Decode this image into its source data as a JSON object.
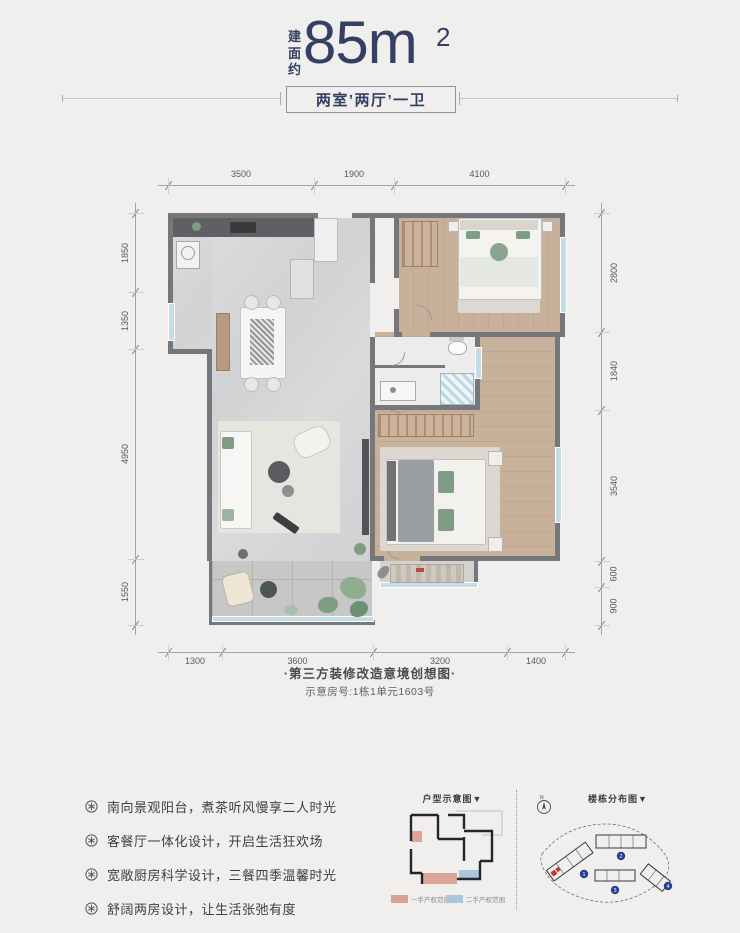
{
  "header": {
    "area_prefix": "建面约",
    "area_value": "85m",
    "area_sup": "2",
    "layout_label": "两室’两厅’一卫"
  },
  "plan": {
    "dims_top": [
      "3500",
      "1900",
      "4100"
    ],
    "dims_left": [
      "1850",
      "1350",
      "4950",
      "1550"
    ],
    "dims_right": [
      "2800",
      "1840",
      "3540",
      "600",
      "900"
    ],
    "dims_bottom": [
      "1300",
      "3600",
      "3200",
      "1400"
    ]
  },
  "caption": {
    "line1": "·第三方装修改造意境创想图·",
    "line2": "示意房号:1栋1单元1603号"
  },
  "features": {
    "items": [
      {
        "text": "南向景观阳台，煮茶听风慢享二人时光"
      },
      {
        "text": "客餐厅一体化设计，开启生活狂欢场"
      },
      {
        "text": "宽敞厨房科学设计，三餐四季温馨时光"
      },
      {
        "text": "舒阔两房设计，让生活张弛有度"
      }
    ]
  },
  "diagrams": {
    "unit": {
      "title": "户型示意图▼",
      "legend": [
        {
          "label": "一手产权范围",
          "color": "#d9a493"
        },
        {
          "label": "二手产权范围",
          "color": "#a9c7dc"
        }
      ]
    },
    "site": {
      "title": "楼栋分布图▼",
      "compass": "N",
      "buildings": [
        "1",
        "2",
        "3",
        "4"
      ]
    }
  },
  "colors": {
    "navy": "#333f63",
    "wall_gray": "#76777b",
    "wood": "#c7b09a",
    "marble": "#d8d8da",
    "legend_pink": "#d9a493",
    "legend_blue": "#a9c7dc",
    "accent_green": "#7f9d85",
    "site_marker_blue": "#24418e",
    "unit_marker_red": "#c03a2b"
  }
}
